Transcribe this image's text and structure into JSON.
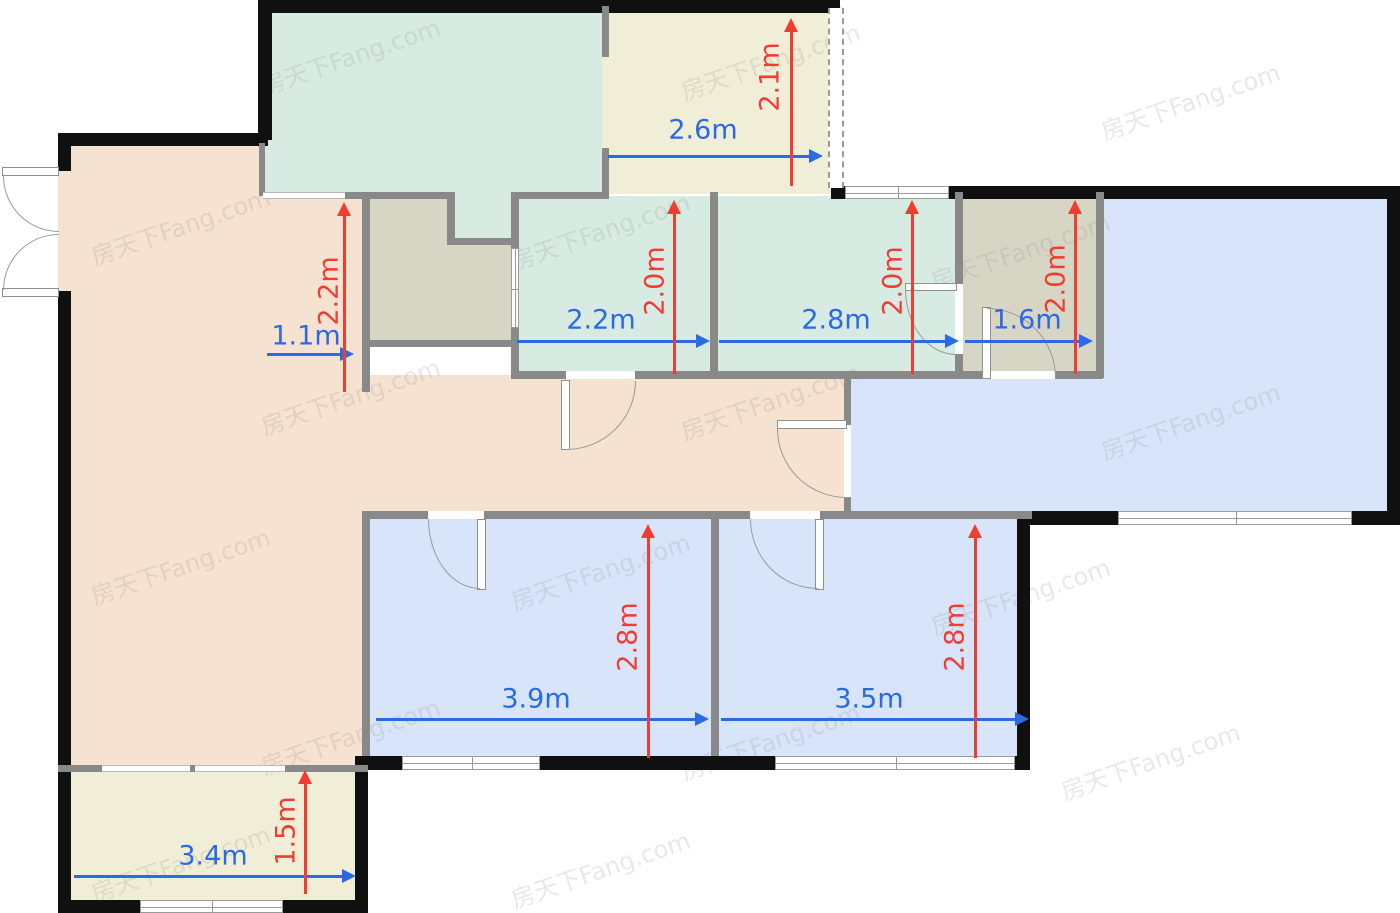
{
  "canvas": {
    "w": 1400,
    "h": 913,
    "background": "#ffffff"
  },
  "palette": {
    "wall_exterior": "#101010",
    "wall_interior": "#898989",
    "window_frame": "#9a9a9a",
    "floor_tan": "#f5e2d0",
    "floor_teal": "#d7ebe3",
    "floor_cream": "#f1eed7",
    "floor_graygreen": "#d7d5c3",
    "floor_blue": "#d7e4fa",
    "dim_blue": "#2a6ae4",
    "dim_red": "#f23b31"
  },
  "watermark": {
    "text": "房天下Fang.com",
    "positions": [
      {
        "x": 350,
        "y": 55
      },
      {
        "x": 770,
        "y": 60
      },
      {
        "x": 1190,
        "y": 100
      },
      {
        "x": 180,
        "y": 225
      },
      {
        "x": 600,
        "y": 230
      },
      {
        "x": 1020,
        "y": 250
      },
      {
        "x": 350,
        "y": 395
      },
      {
        "x": 770,
        "y": 400
      },
      {
        "x": 1190,
        "y": 420
      },
      {
        "x": 180,
        "y": 565
      },
      {
        "x": 600,
        "y": 570
      },
      {
        "x": 1020,
        "y": 595
      },
      {
        "x": 350,
        "y": 735
      },
      {
        "x": 770,
        "y": 740
      },
      {
        "x": 1150,
        "y": 760
      },
      {
        "x": 180,
        "y": 862
      },
      {
        "x": 600,
        "y": 868
      }
    ]
  },
  "floors": [
    {
      "name": "living-room-floor",
      "x": 58,
      "y": 133,
      "w": 310,
      "h": 639,
      "color": "#f5e2d0"
    },
    {
      "name": "hallway-floor",
      "x": 362,
      "y": 375,
      "w": 489,
      "h": 144,
      "color": "#f5e2d0"
    },
    {
      "name": "kitchen-floor",
      "x": 263,
      "y": 6,
      "w": 342,
      "h": 190,
      "color": "#d7ebe3"
    },
    {
      "name": "storage-room-floor",
      "x": 365,
      "y": 196,
      "w": 150,
      "h": 148,
      "color": "#d7d5c3"
    },
    {
      "name": "kitchen-duct-floor",
      "x": 450,
      "y": 192,
      "w": 65,
      "h": 50,
      "color": "#d7ebe3"
    },
    {
      "name": "north-balcony-floor",
      "x": 602,
      "y": 6,
      "w": 240,
      "h": 188,
      "color": "#f1eed7"
    },
    {
      "name": "teal-room-west-floor",
      "x": 513,
      "y": 196,
      "w": 202,
      "h": 182,
      "color": "#d7ebe3"
    },
    {
      "name": "teal-room-east-floor",
      "x": 713,
      "y": 196,
      "w": 248,
      "h": 182,
      "color": "#d7ebe3"
    },
    {
      "name": "bathroom-floor",
      "x": 958,
      "y": 196,
      "w": 145,
      "h": 182,
      "color": "#d7d5c3"
    },
    {
      "name": "dining-room-floor",
      "x": 1100,
      "y": 190,
      "w": 295,
      "h": 332,
      "color": "#d7e4fa"
    },
    {
      "name": "dining-room-floor-west",
      "x": 848,
      "y": 378,
      "w": 260,
      "h": 140,
      "color": "#d7e4fa"
    },
    {
      "name": "bedroom-west-floor",
      "x": 365,
      "y": 515,
      "w": 350,
      "h": 250,
      "color": "#d7e4fa"
    },
    {
      "name": "bedroom-east-floor",
      "x": 715,
      "y": 515,
      "w": 315,
      "h": 250,
      "color": "#d7e4fa"
    },
    {
      "name": "south-balcony-floor",
      "x": 58,
      "y": 770,
      "w": 310,
      "h": 140,
      "color": "#f1eed7"
    }
  ],
  "walls_exterior": [
    {
      "x": 58,
      "y": 133,
      "w": 210,
      "h": 13
    },
    {
      "x": 58,
      "y": 133,
      "w": 13,
      "h": 38
    },
    {
      "x": 58,
      "y": 291,
      "w": 13,
      "h": 481
    },
    {
      "x": 258,
      "y": 0,
      "w": 14,
      "h": 140
    },
    {
      "x": 258,
      "y": 0,
      "w": 582,
      "h": 13
    },
    {
      "x": 831,
      "y": 186,
      "w": 16,
      "h": 13
    },
    {
      "x": 948,
      "y": 186,
      "w": 452,
      "h": 13
    },
    {
      "x": 1387,
      "y": 186,
      "w": 13,
      "h": 339
    },
    {
      "x": 1030,
      "y": 511,
      "w": 370,
      "h": 14
    },
    {
      "x": 1017,
      "y": 518,
      "w": 13,
      "h": 252
    },
    {
      "x": 360,
      "y": 756,
      "w": 670,
      "h": 14
    },
    {
      "x": 58,
      "y": 770,
      "w": 13,
      "h": 143
    },
    {
      "x": 58,
      "y": 900,
      "w": 310,
      "h": 13
    },
    {
      "x": 355,
      "y": 756,
      "w": 13,
      "h": 157
    }
  ],
  "walls_interior": [
    {
      "x": 259,
      "y": 143,
      "w": 6,
      "h": 53
    },
    {
      "x": 345,
      "y": 192,
      "w": 107,
      "h": 7
    },
    {
      "x": 362,
      "y": 192,
      "w": 8,
      "h": 200
    },
    {
      "x": 447,
      "y": 192,
      "w": 8,
      "h": 52
    },
    {
      "x": 447,
      "y": 238,
      "w": 70,
      "h": 7
    },
    {
      "x": 511,
      "y": 192,
      "w": 8,
      "h": 56
    },
    {
      "x": 511,
      "y": 328,
      "w": 8,
      "h": 50
    },
    {
      "x": 517,
      "y": 192,
      "w": 92,
      "h": 7
    },
    {
      "x": 602,
      "y": 6,
      "w": 7,
      "h": 51
    },
    {
      "x": 602,
      "y": 148,
      "w": 7,
      "h": 46
    },
    {
      "x": 710,
      "y": 192,
      "w": 8,
      "h": 186
    },
    {
      "x": 955,
      "y": 192,
      "w": 8,
      "h": 92
    },
    {
      "x": 955,
      "y": 354,
      "w": 8,
      "h": 24
    },
    {
      "x": 1096,
      "y": 192,
      "w": 8,
      "h": 186
    },
    {
      "x": 511,
      "y": 371,
      "w": 55,
      "h": 8
    },
    {
      "x": 635,
      "y": 371,
      "w": 328,
      "h": 8
    },
    {
      "x": 958,
      "y": 371,
      "w": 30,
      "h": 8
    },
    {
      "x": 1055,
      "y": 371,
      "w": 48,
      "h": 8
    },
    {
      "x": 844,
      "y": 378,
      "w": 7,
      "h": 47
    },
    {
      "x": 844,
      "y": 497,
      "w": 7,
      "h": 21
    },
    {
      "x": 362,
      "y": 511,
      "w": 66,
      "h": 8
    },
    {
      "x": 484,
      "y": 511,
      "w": 266,
      "h": 8
    },
    {
      "x": 820,
      "y": 511,
      "w": 212,
      "h": 8
    },
    {
      "x": 711,
      "y": 519,
      "w": 8,
      "h": 237
    },
    {
      "x": 362,
      "y": 519,
      "w": 8,
      "h": 237
    },
    {
      "x": 58,
      "y": 765,
      "w": 44,
      "h": 7
    },
    {
      "x": 285,
      "y": 765,
      "w": 83,
      "h": 7
    },
    {
      "x": 190,
      "y": 765,
      "w": 5,
      "h": 7
    },
    {
      "x": 368,
      "y": 340,
      "w": 148,
      "h": 7
    }
  ],
  "windows": [
    {
      "name": "window-north",
      "x": 845,
      "y": 186,
      "w": 104,
      "h": 13,
      "dir": "h",
      "mull": 52
    },
    {
      "name": "window-dining-south",
      "x": 1118,
      "y": 511,
      "w": 234,
      "h": 14,
      "dir": "h",
      "mull": 117
    },
    {
      "name": "window-bedroom-west",
      "x": 402,
      "y": 756,
      "w": 138,
      "h": 14,
      "dir": "h",
      "mull": 69
    },
    {
      "name": "window-bedroom-east",
      "x": 775,
      "y": 756,
      "w": 240,
      "h": 14,
      "dir": "h",
      "mull": 120
    },
    {
      "name": "window-south-balcony",
      "x": 140,
      "y": 900,
      "w": 143,
      "h": 13,
      "dir": "h",
      "mull": 71
    },
    {
      "name": "window-teal-west-wall",
      "x": 511,
      "y": 248,
      "w": 8,
      "h": 80,
      "dir": "v",
      "mull": 40
    }
  ],
  "openings": [
    {
      "name": "pass-kitchen-living",
      "x": 263,
      "y": 192,
      "w": 82,
      "h": 7,
      "dir": "h"
    },
    {
      "name": "slider-balcony-1",
      "x": 102,
      "y": 765,
      "w": 88,
      "h": 7,
      "dir": "h"
    },
    {
      "name": "slider-balcony-2",
      "x": 195,
      "y": 765,
      "w": 90,
      "h": 7,
      "dir": "h"
    },
    {
      "name": "gap-tealeast-bathroom",
      "x": 955,
      "y": 284,
      "w": 8,
      "h": 70,
      "dir": "plain"
    },
    {
      "name": "gap-hall-dining",
      "x": 844,
      "y": 425,
      "w": 7,
      "h": 72,
      "dir": "plain"
    },
    {
      "name": "gap-bedroom-west-door",
      "x": 428,
      "y": 511,
      "w": 56,
      "h": 8,
      "dir": "plain"
    },
    {
      "name": "gap-bedroom-east-door",
      "x": 750,
      "y": 511,
      "w": 70,
      "h": 8,
      "dir": "plain"
    },
    {
      "name": "gap-tealwest-door",
      "x": 566,
      "y": 371,
      "w": 69,
      "h": 8,
      "dir": "plain"
    },
    {
      "name": "gap-bathroom-door",
      "x": 988,
      "y": 371,
      "w": 67,
      "h": 8,
      "dir": "plain"
    }
  ],
  "dashed_walls": [
    {
      "name": "glass-wall-north-balcony",
      "x": 828,
      "y": 8,
      "w": 16,
      "h": 180
    }
  ],
  "door_leaves": [
    {
      "x": 2,
      "y": 167,
      "w": 57,
      "h": 9
    },
    {
      "x": 2,
      "y": 288,
      "w": 57,
      "h": 9
    },
    {
      "x": 561,
      "y": 380,
      "w": 9,
      "h": 70
    },
    {
      "x": 477,
      "y": 519,
      "w": 9,
      "h": 71
    },
    {
      "x": 815,
      "y": 519,
      "w": 9,
      "h": 71
    },
    {
      "x": 777,
      "y": 420,
      "w": 70,
      "h": 9
    },
    {
      "x": 905,
      "y": 283,
      "w": 52,
      "h": 8
    },
    {
      "x": 982,
      "y": 307,
      "w": 9,
      "h": 72
    }
  ],
  "door_arcs": [
    {
      "x": 3,
      "y": 176,
      "w": 56,
      "h": 56,
      "corner": "bl"
    },
    {
      "x": 3,
      "y": 234,
      "w": 56,
      "h": 56,
      "corner": "tl"
    },
    {
      "x": 566,
      "y": 381,
      "w": 70,
      "h": 69,
      "corner": "br"
    },
    {
      "x": 428,
      "y": 519,
      "w": 52,
      "h": 70,
      "corner": "bl"
    },
    {
      "x": 750,
      "y": 519,
      "w": 68,
      "h": 70,
      "corner": "bl"
    },
    {
      "x": 777,
      "y": 429,
      "w": 70,
      "h": 69,
      "corner": "bl"
    },
    {
      "x": 905,
      "y": 289,
      "w": 51,
      "h": 66,
      "corner": "bl"
    },
    {
      "x": 987,
      "y": 308,
      "w": 69,
      "h": 70,
      "corner": "tr"
    }
  ],
  "dimensions": [
    {
      "label": "2.6m",
      "axis": "h",
      "color": "blue",
      "x1": 608,
      "x2": 823,
      "y": 156,
      "label_x": 703,
      "label_y": 130
    },
    {
      "label": "1.1m",
      "axis": "h",
      "color": "blue",
      "x1": 267,
      "x2": 354,
      "y": 354,
      "label_x": 306,
      "label_y": 336
    },
    {
      "label": "2.2m",
      "axis": "h",
      "color": "blue",
      "x1": 517,
      "x2": 710,
      "y": 341,
      "label_x": 601,
      "label_y": 320
    },
    {
      "label": "2.8m",
      "axis": "h",
      "color": "blue",
      "x1": 719,
      "x2": 959,
      "y": 341,
      "label_x": 836,
      "label_y": 320
    },
    {
      "label": "1.6m",
      "axis": "h",
      "color": "blue",
      "x1": 965,
      "x2": 1093,
      "y": 341,
      "label_x": 1027,
      "label_y": 320
    },
    {
      "label": "3.9m",
      "axis": "h",
      "color": "blue",
      "x1": 376,
      "x2": 709,
      "y": 719,
      "label_x": 536,
      "label_y": 699
    },
    {
      "label": "3.5m",
      "axis": "h",
      "color": "blue",
      "x1": 721,
      "x2": 1029,
      "y": 719,
      "label_x": 869,
      "label_y": 699
    },
    {
      "label": "3.4m",
      "axis": "h",
      "color": "blue",
      "x1": 74,
      "x2": 356,
      "y": 876,
      "label_x": 213,
      "label_y": 856
    },
    {
      "label": "2.1m",
      "axis": "v",
      "color": "red",
      "y1": 18,
      "y2": 186,
      "x": 791,
      "label_x": 770,
      "label_y": 77
    },
    {
      "label": "2.2m",
      "axis": "v",
      "color": "red",
      "y1": 202,
      "y2": 392,
      "x": 344,
      "label_x": 329,
      "label_y": 291
    },
    {
      "label": "2.0m",
      "axis": "v",
      "color": "red",
      "y1": 200,
      "y2": 374,
      "x": 674,
      "label_x": 655,
      "label_y": 281
    },
    {
      "label": "2.0m",
      "axis": "v",
      "color": "red",
      "y1": 200,
      "y2": 374,
      "x": 912,
      "label_x": 893,
      "label_y": 281
    },
    {
      "label": "2.0m",
      "axis": "v",
      "color": "red",
      "y1": 200,
      "y2": 374,
      "x": 1075,
      "label_x": 1056,
      "label_y": 279
    },
    {
      "label": "2.8m",
      "axis": "v",
      "color": "red",
      "y1": 524,
      "y2": 758,
      "x": 648,
      "label_x": 628,
      "label_y": 637
    },
    {
      "label": "2.8m",
      "axis": "v",
      "color": "red",
      "y1": 524,
      "y2": 758,
      "x": 975,
      "label_x": 955,
      "label_y": 637
    },
    {
      "label": "1.5m",
      "axis": "v",
      "color": "red",
      "y1": 770,
      "y2": 894,
      "x": 305,
      "label_x": 286,
      "label_y": 831
    }
  ],
  "rooms_summary": [
    {
      "name": "north balcony",
      "width": "2.6m",
      "depth": "2.1m"
    },
    {
      "name": "entry nook",
      "width": "1.1m",
      "depth": "2.2m"
    },
    {
      "name": "teal room west",
      "width": "2.2m",
      "depth": "2.0m"
    },
    {
      "name": "teal room east",
      "width": "2.8m",
      "depth": "2.0m"
    },
    {
      "name": "bathroom",
      "width": "1.6m",
      "depth": "2.0m"
    },
    {
      "name": "bedroom west",
      "width": "3.9m",
      "depth": "2.8m"
    },
    {
      "name": "bedroom east",
      "width": "3.5m",
      "depth": "2.8m"
    },
    {
      "name": "south balcony",
      "width": "3.4m",
      "depth": "1.5m"
    }
  ]
}
